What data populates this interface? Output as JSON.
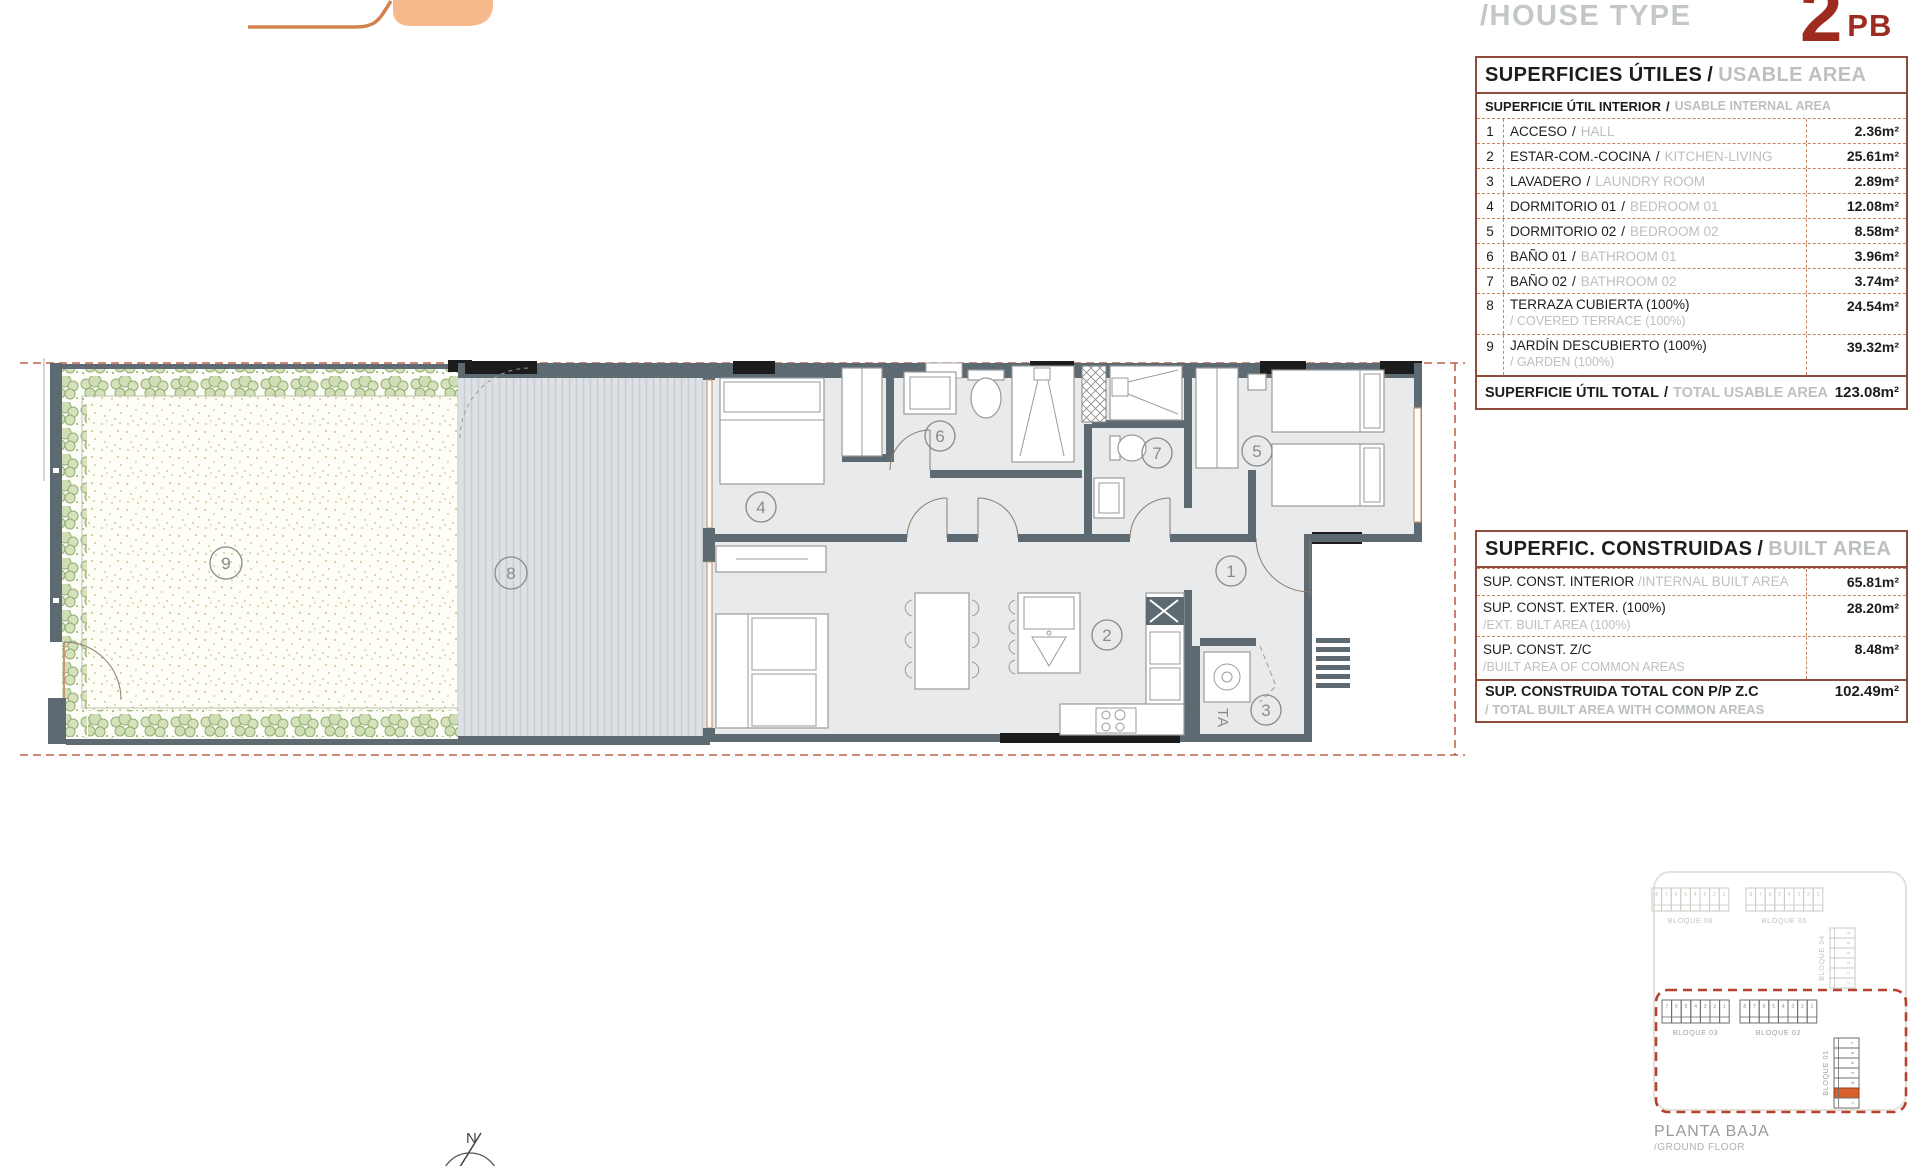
{
  "header": {
    "house_type_label": "/HOUSE TYPE",
    "unit_number": "2",
    "unit_suffix": "PB",
    "accent_color": "#9e2b20"
  },
  "usable_table": {
    "slash": "/",
    "title_es": "SUPERFICIES ÚTILES",
    "title_en": "USABLE AREA",
    "subtitle_es": "SUPERFICIE ÚTIL INTERIOR",
    "subtitle_en": "USABLE INTERNAL AREA",
    "rows": [
      {
        "num": "1",
        "es": "ACCESO",
        "en": "HALL",
        "value": "2.36m²"
      },
      {
        "num": "2",
        "es": "ESTAR-COM.-COCINA",
        "en": "KITCHEN-LIVING",
        "value": "25.61m²"
      },
      {
        "num": "3",
        "es": "LAVADERO",
        "en": "LAUNDRY ROOM",
        "value": "2.89m²"
      },
      {
        "num": "4",
        "es": "DORMITORIO 01",
        "en": "BEDROOM 01",
        "value": "12.08m²"
      },
      {
        "num": "5",
        "es": "DORMITORIO 02",
        "en": "BEDROOM 02",
        "value": "8.58m²"
      },
      {
        "num": "6",
        "es": "BAÑO 01",
        "en": "BATHROOM 01",
        "value": "3.96m²"
      },
      {
        "num": "7",
        "es": "BAÑO 02",
        "en": "BATHROOM 02",
        "value": "3.74m²"
      },
      {
        "num": "8",
        "es": "TERRAZA CUBIERTA (100%)",
        "en": "/ COVERED TERRACE (100%)",
        "value": "24.54m²"
      },
      {
        "num": "9",
        "es": "JARDÍN DESCUBIERTO (100%)",
        "en": "/ GARDEN (100%)",
        "value": "39.32m²"
      }
    ],
    "total_es": "SUPERFICIE ÚTIL TOTAL",
    "total_en": "TOTAL USABLE AREA",
    "total_value": "123.08m²"
  },
  "built_table": {
    "slash": "/",
    "title_es": "SUPERFIC. CONSTRUIDAS",
    "title_en": "BUILT AREA",
    "rows": [
      {
        "es": "SUP. CONST. INTERIOR",
        "en": "/INTERNAL BUILT AREA",
        "value": "65.81m²"
      },
      {
        "es": "SUP. CONST. EXTER. (100%)",
        "en": "/EXT. BUILT AREA (100%)",
        "value": "28.20m²"
      },
      {
        "es": "SUP. CONST. Z/C",
        "en": "/BUILT AREA OF COMMON AREAS",
        "value": "8.48m²"
      }
    ],
    "total_es": "SUP. CONSTRUIDA TOTAL CON P/P Z.C",
    "total_en": "/ TOTAL BUILT AREA WITH COMMON AREAS",
    "total_value": "102.49m²"
  },
  "floorplan": {
    "rooms": [
      "1",
      "2",
      "3",
      "4",
      "5",
      "6",
      "7",
      "8",
      "9"
    ],
    "laundry_label": "TA",
    "wall_color": "#5d6a72",
    "room_fill": "#e9eaeb",
    "terrace_fill": "#dde1e4",
    "hedge_color": "#9cb77c",
    "boundary_color": "#c0614a"
  },
  "siteplan": {
    "blocks": [
      {
        "label": "BLOQUE 06",
        "cells": [
          "8",
          "7",
          "6",
          "5",
          "4",
          "3",
          "2",
          "1"
        ],
        "faded": true
      },
      {
        "label": "BLOQUE 05",
        "cells": [
          "8",
          "7",
          "6",
          "5",
          "4",
          "3",
          "2",
          "1"
        ],
        "faded": true
      },
      {
        "label": "BLOQUE 04",
        "cells": [
          "6",
          "5",
          "4",
          "3",
          "2",
          "1"
        ],
        "faded": true
      },
      {
        "label": "BLOQUE 03",
        "cells": [
          "7",
          "6",
          "5",
          "4",
          "3",
          "2",
          "1"
        ]
      },
      {
        "label": "BLOQUE 02",
        "cells": [
          "8",
          "7",
          "6",
          "5",
          "4",
          "3",
          "2",
          "1"
        ]
      },
      {
        "label": "BLOQUE 01",
        "cells": [
          "7",
          "6",
          "5",
          "4",
          "3",
          "2",
          "1"
        ],
        "highlight": "2"
      }
    ],
    "highlight_color": "#d95f2b",
    "outline_color": "#b5412e",
    "caption_line1": "PLANTA BAJA",
    "caption_line2": "/GROUND FLOOR"
  },
  "compass": {
    "label": "N"
  }
}
